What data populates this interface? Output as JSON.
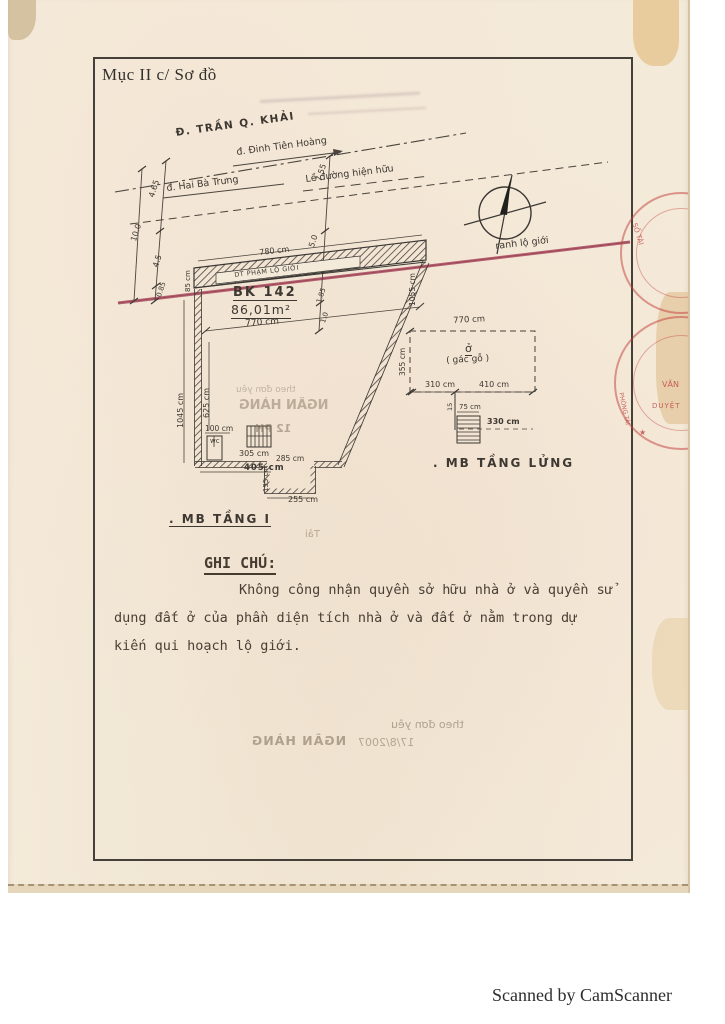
{
  "page": {
    "section_title": "Mục II c/ Sơ đồ",
    "footer": "Scanned by CamScanner"
  },
  "colors": {
    "paper": "#f4ead9",
    "ink": "#3d3831",
    "road_boundary_red": "#aa4a5f",
    "stamp_red": "#c23b38"
  },
  "streets": {
    "tran_q_khai": "Đ. TRẦN Q. KHẢI",
    "dinh_tien_hoang": "đ. Đinh Tiên Hoàng",
    "hai_ba_trung": "đ. Hai Bà Trưng",
    "sidewalk": "Lề đường hiện hữu",
    "road_boundary": "ranh lộ giới"
  },
  "dims": {
    "left": [
      "4.65",
      "10.0",
      "4.5",
      "0.85"
    ],
    "right": [
      "7.55",
      "5.0",
      "1.85",
      "1.0"
    ]
  },
  "strip": {
    "width": "780 cm",
    "label": "DT PHẠM LỘ GIỚI",
    "height": "85 cm"
  },
  "plot": {
    "parcel_id": "BK 142",
    "area": "86,01m²",
    "width": "770 cm",
    "left_depth": "1045 cm",
    "left_inner": "625 cm",
    "right_depth": "1055 cm",
    "room_width": "100 cm",
    "wc": "wc",
    "bottom_inner": "305 cm",
    "bottom": "405 cm",
    "annex_top": "285 cm",
    "annex_height": "155 cm",
    "annex_bottom": "255 cm",
    "caption": ". MB TẦNG I"
  },
  "mezzanine": {
    "width": "770 cm",
    "height": "355 cm",
    "room": "ở",
    "room_sub": "( gác gỗ )",
    "d310": "310 cm",
    "d410": "410 cm",
    "d15": "15",
    "d75": "75 cm",
    "d330": "330 cm",
    "caption": ". MB TẦNG LỬNG"
  },
  "note": {
    "heading": "GHI CHÚ:",
    "line1": "Không công nhận quyền sở hữu nhà ở và quyền sử",
    "line2": "dụng đất ở của phần diện tích nhà ở và đất ở nằm trong dự",
    "line3": "kiến qui hoạch lộ giới."
  },
  "bleed": {
    "plot_line1": "theo đơn yêu",
    "plot_line2": "NGÂN HÀNG",
    "plot_line3": "12 PH",
    "mid": "Tải",
    "bottom_line1": "theo đơn yêu",
    "bottom_date": "17/8/2007",
    "bottom_bank": "NGÂN HÀNG"
  },
  "stamps": {
    "t1": "SỐ TÀI",
    "t2": "VĂN",
    "t3": "DUYỆT",
    "t4": "PHÒNG TÀI",
    "star": "★"
  }
}
